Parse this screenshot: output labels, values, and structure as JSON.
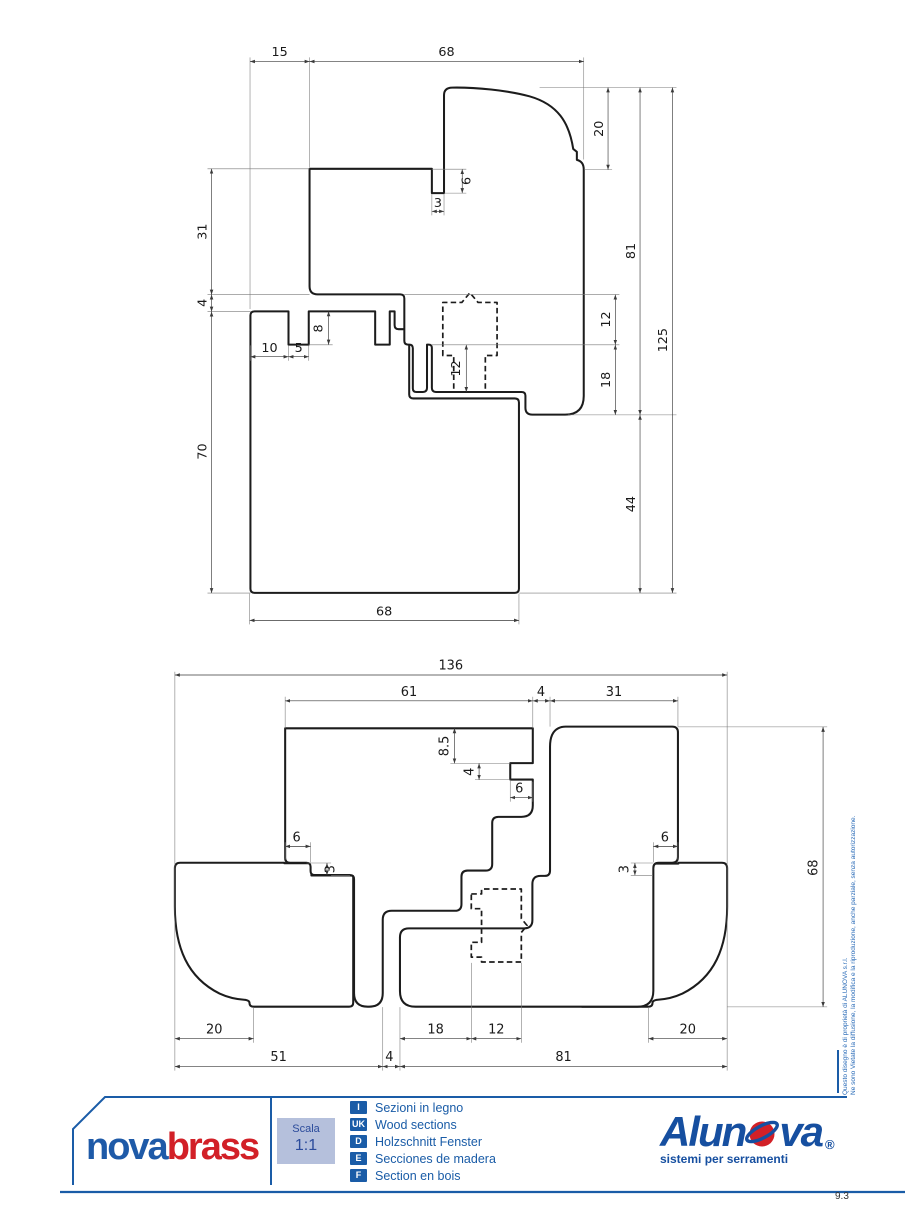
{
  "page": {
    "number": "9.3"
  },
  "copyright": {
    "line1": "Questo disegno è di proprietà di ALUNOVA s.r.l.",
    "line2": "Ne sono Vietate la diffusione, la modifica e la riproduzione, anche parziale, senza autorizzazione."
  },
  "colors": {
    "accent_blue": "#1a5ca7",
    "brand_blue": "#1e5aa8",
    "brand_red": "#d22027",
    "scala_box_bg": "#b5c0dc",
    "drawing_line": "#1c1c1c"
  },
  "footer": {
    "brand_left": {
      "part_blue": "nova",
      "part_red": "brass"
    },
    "scale_box": {
      "label": "Scala",
      "value": "1:1"
    },
    "legend": {
      "items": [
        {
          "code": "I",
          "text": "Sezioni in legno"
        },
        {
          "code": "UK",
          "text": "Wood sections"
        },
        {
          "code": "D",
          "text": "Holzschnitt Fenster"
        },
        {
          "code": "E",
          "text": "Secciones de madera"
        },
        {
          "code": "F",
          "text": "Section en bois"
        }
      ]
    },
    "brand_right": {
      "part1": "Alun",
      "part2": "va",
      "registered": "®",
      "tagline": "sistemi per serramenti"
    }
  },
  "drawing_top": {
    "dims": {
      "d15": "15",
      "d68_top": "68",
      "d20": "20",
      "d6": "6",
      "d3": "3",
      "d31": "31",
      "d4": "4",
      "d8": "8",
      "d10": "10",
      "d5": "5",
      "d12_center": "12",
      "d12_right": "12",
      "d18": "18",
      "d81": "81",
      "d125": "125",
      "d70": "70",
      "d44": "44",
      "d68_bottom": "68"
    }
  },
  "drawing_bottom": {
    "dims": {
      "d136": "136",
      "d61": "61",
      "d4_top": "4",
      "d31": "31",
      "d8_5": "8.5",
      "d4_notch": "4",
      "d6_notch": "6",
      "d6_left": "6",
      "d3_left": "3",
      "d6_right": "6",
      "d3_right": "3",
      "d68": "68",
      "d20_left": "20",
      "d18": "18",
      "d12": "12",
      "d20_right": "20",
      "d51": "51",
      "d4_bottom": "4",
      "d81": "81"
    }
  }
}
